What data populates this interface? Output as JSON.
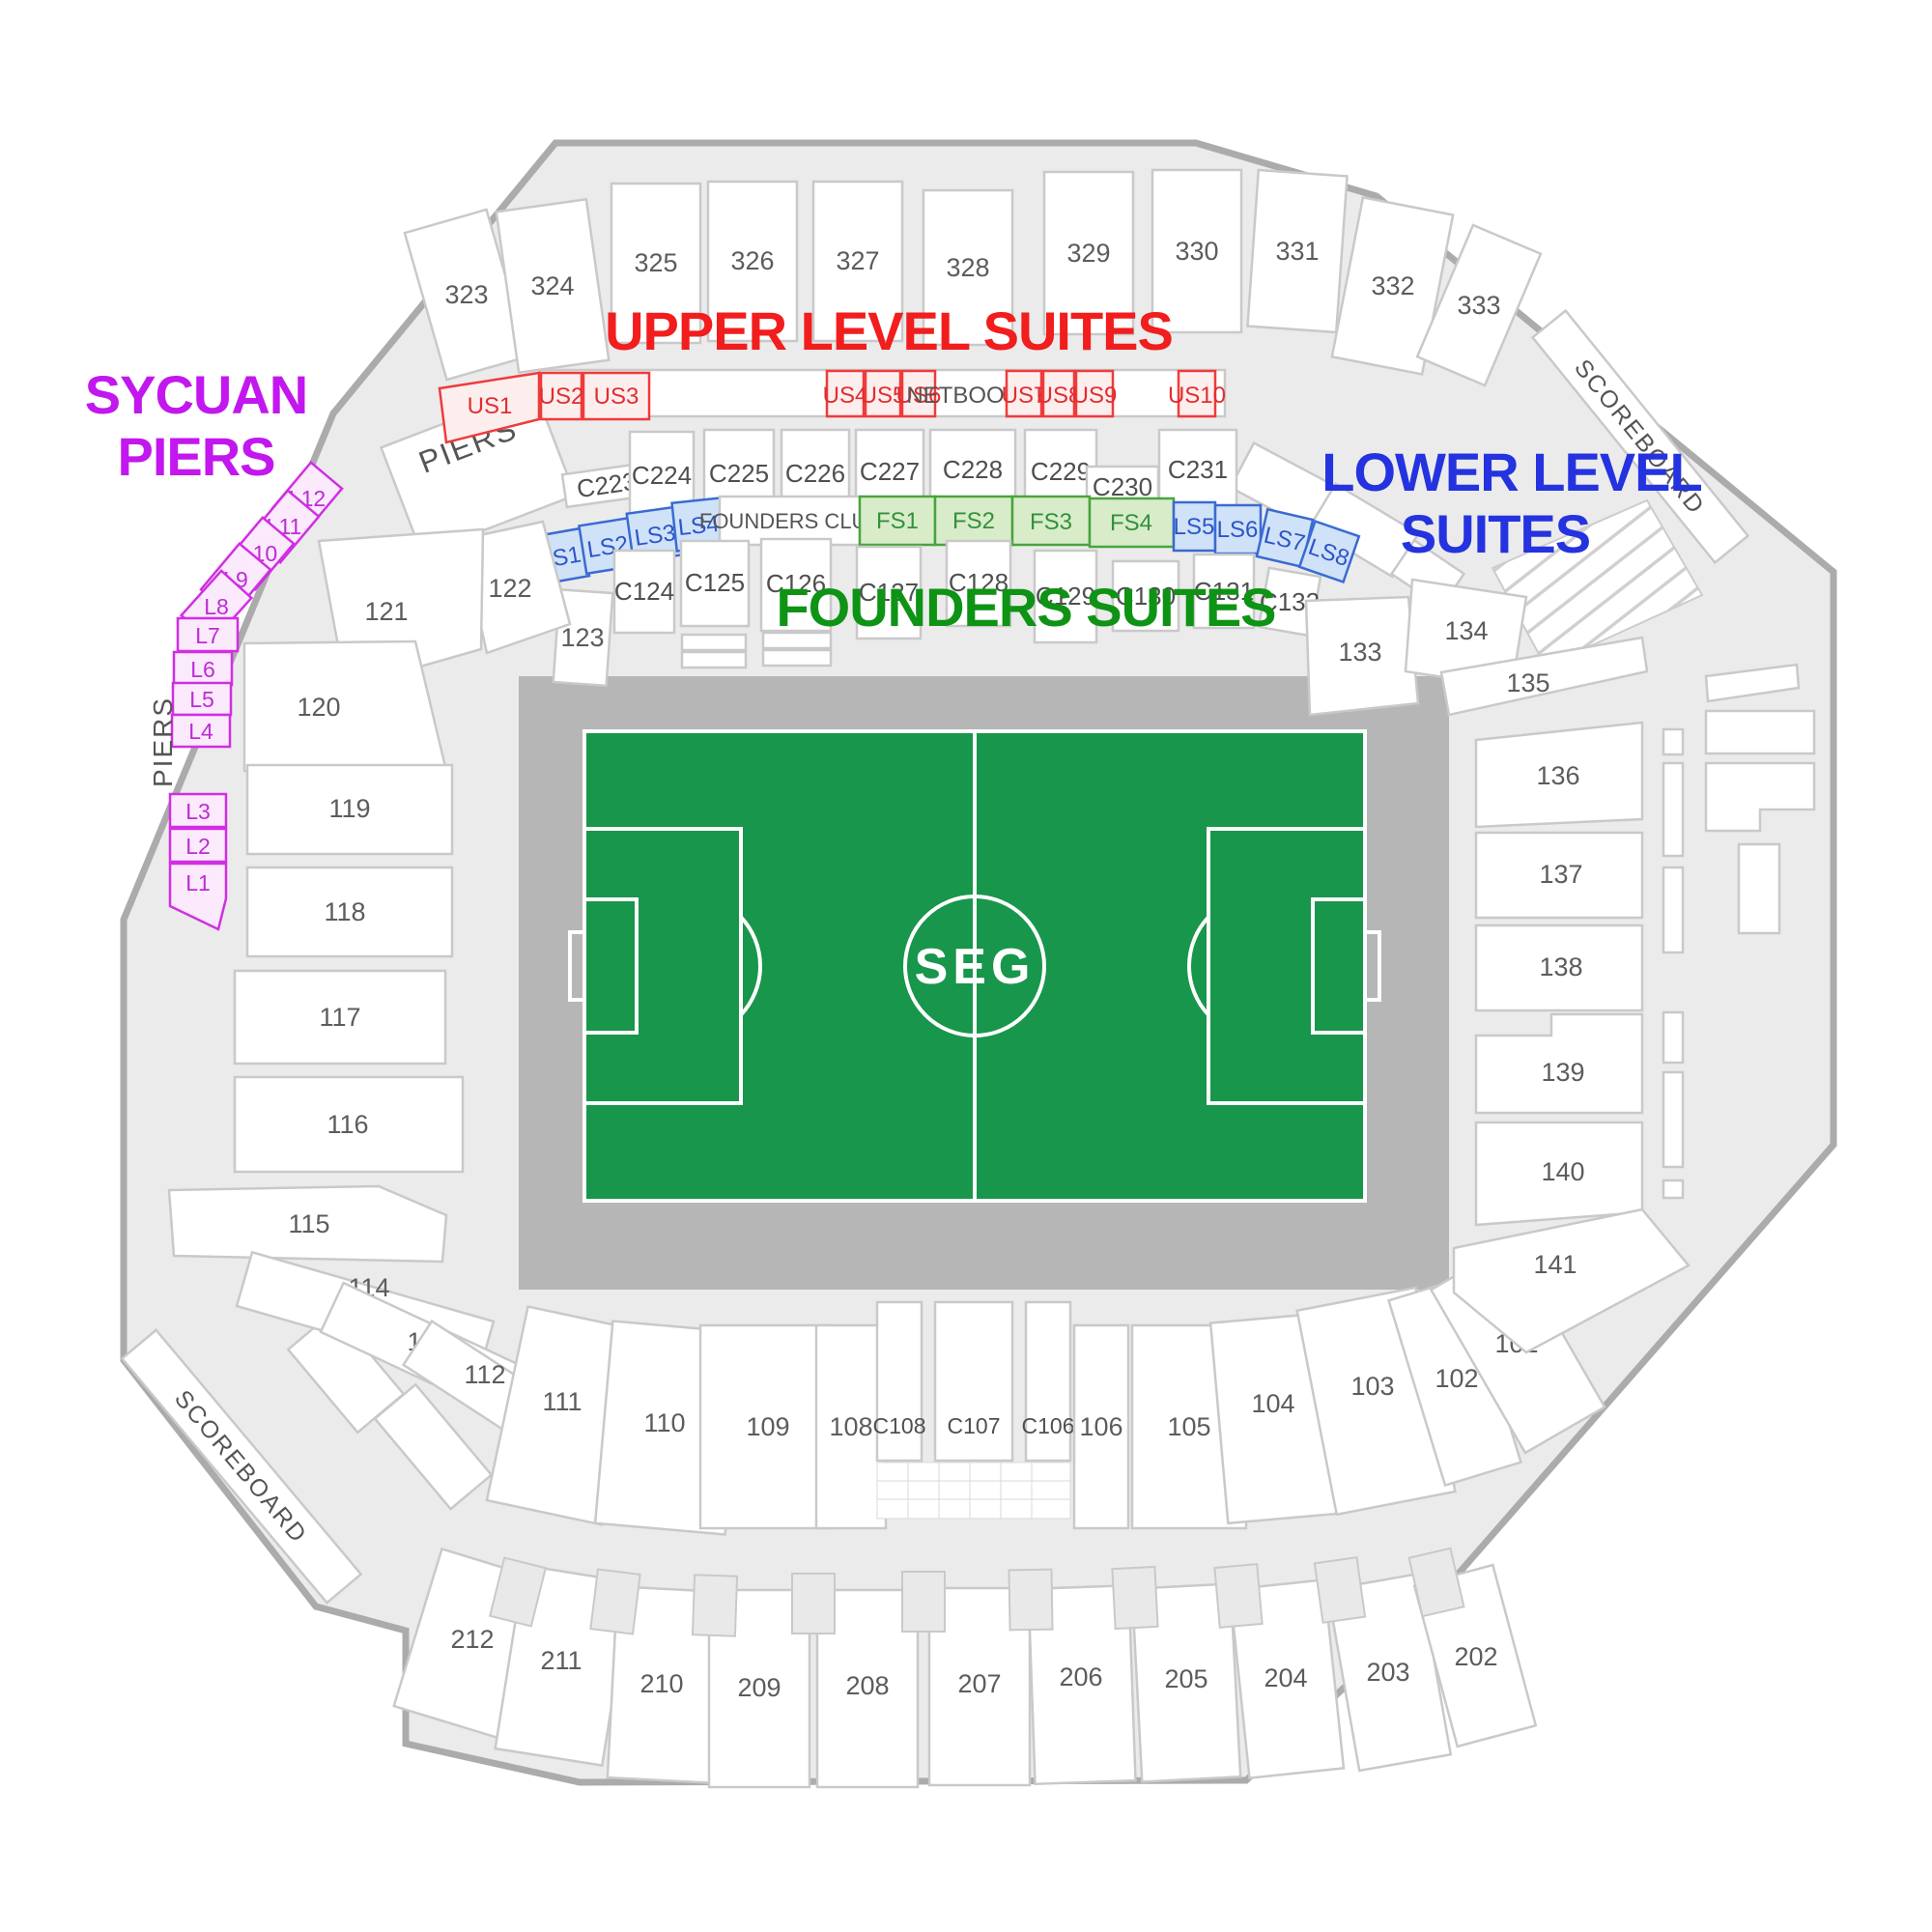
{
  "titles": {
    "upper_level_suites": "UPPER LEVEL SUITES",
    "lower_level_line1": "LOWER LEVEL",
    "lower_level_line2": "SUITES",
    "founders_suites": "FOUNDERS SUITES",
    "sycuan_line1": "SYCUAN",
    "sycuan_line2": "PIERS"
  },
  "field": {
    "logo": "SEG"
  },
  "labels": {
    "netbooth": "NETBOOTH",
    "founders_club": "FOUNDERS CLUB",
    "piers_upper": "PIERS",
    "piers_west": "PIERS",
    "scoreboard_ne": "SCOREBOARD",
    "scoreboard_sw": "SCOREBOARD"
  },
  "suites": {
    "upper": [
      "US1",
      "US2",
      "US3",
      "US4",
      "US5",
      "US6",
      "US7",
      "US8",
      "US9",
      "US10"
    ],
    "lower": [
      "LS1",
      "LS2",
      "LS3",
      "LS4",
      "LS5",
      "LS6",
      "LS7",
      "LS8"
    ],
    "founders": [
      "FS1",
      "FS2",
      "FS3",
      "FS4"
    ],
    "sycuan_piers": [
      "L1",
      "L2",
      "L3",
      "L4",
      "L5",
      "L6",
      "L7",
      "L8",
      "L9",
      "L10",
      "L11",
      "L12"
    ]
  },
  "sections": {
    "level300": [
      "323",
      "324",
      "325",
      "326",
      "327",
      "328",
      "329",
      "330",
      "331",
      "332",
      "333"
    ],
    "c200": [
      "C223",
      "C224",
      "C225",
      "C226",
      "C227",
      "C228",
      "C229",
      "C230",
      "C231"
    ],
    "c100_north": [
      "C124",
      "C125",
      "C126",
      "C127",
      "C128",
      "C129",
      "C130",
      "C131",
      "C132"
    ],
    "c100_south": [
      "C106",
      "C107",
      "C108"
    ],
    "level100_west": [
      "113",
      "114",
      "115",
      "116",
      "117",
      "118",
      "119",
      "120",
      "121",
      "122",
      "123"
    ],
    "level100_south": [
      "101",
      "102",
      "103",
      "104",
      "105",
      "106",
      "108",
      "109",
      "110",
      "111",
      "112"
    ],
    "level100_east": [
      "133",
      "134",
      "135",
      "136",
      "137",
      "138",
      "139",
      "140",
      "141"
    ],
    "level200": [
      "202",
      "203",
      "204",
      "205",
      "206",
      "207",
      "208",
      "209",
      "210",
      "211",
      "212"
    ]
  },
  "colors": {
    "upper_suites_accent": "#ef3b3b",
    "lower_suites_accent": "#3a6ad2",
    "founders_accent": "#49a43c",
    "sycuan_accent": "#d02fe2",
    "field_green": "#18964b",
    "field_apron": "#b6b6b6",
    "concourse": "#ebebeb"
  }
}
